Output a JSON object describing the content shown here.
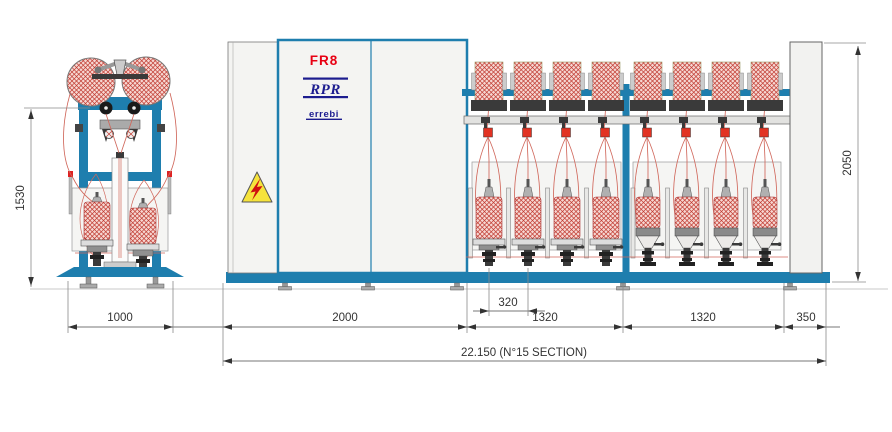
{
  "drawing": {
    "cabinet": {
      "model": "FR8",
      "logo": "RPR",
      "logo_sub": "errebi"
    },
    "dimensions": {
      "end_view_height": "1530",
      "end_view_width": "1000",
      "headstock_width": "2000",
      "spindle_gauge": "320",
      "section_a": "1320",
      "section_b": "1320",
      "tailstock_width": "350",
      "total_length": "22.150 (N°15 SECTION)",
      "machine_height": "2050"
    },
    "icons": {
      "warning": "high-voltage-warning-icon"
    },
    "colors": {
      "frame_blue": "#1e7eae",
      "panel_gray": "#f4f4f2",
      "hatch_red": "#c03a30",
      "hatch_bg": "#f6d7d2",
      "yarn_red": "#d0685c",
      "warning_yellow": "#f6e33b",
      "brand_red": "#e80013",
      "brand_navy": "#1c1c8f",
      "dim_gray": "#3a3a3a"
    }
  }
}
